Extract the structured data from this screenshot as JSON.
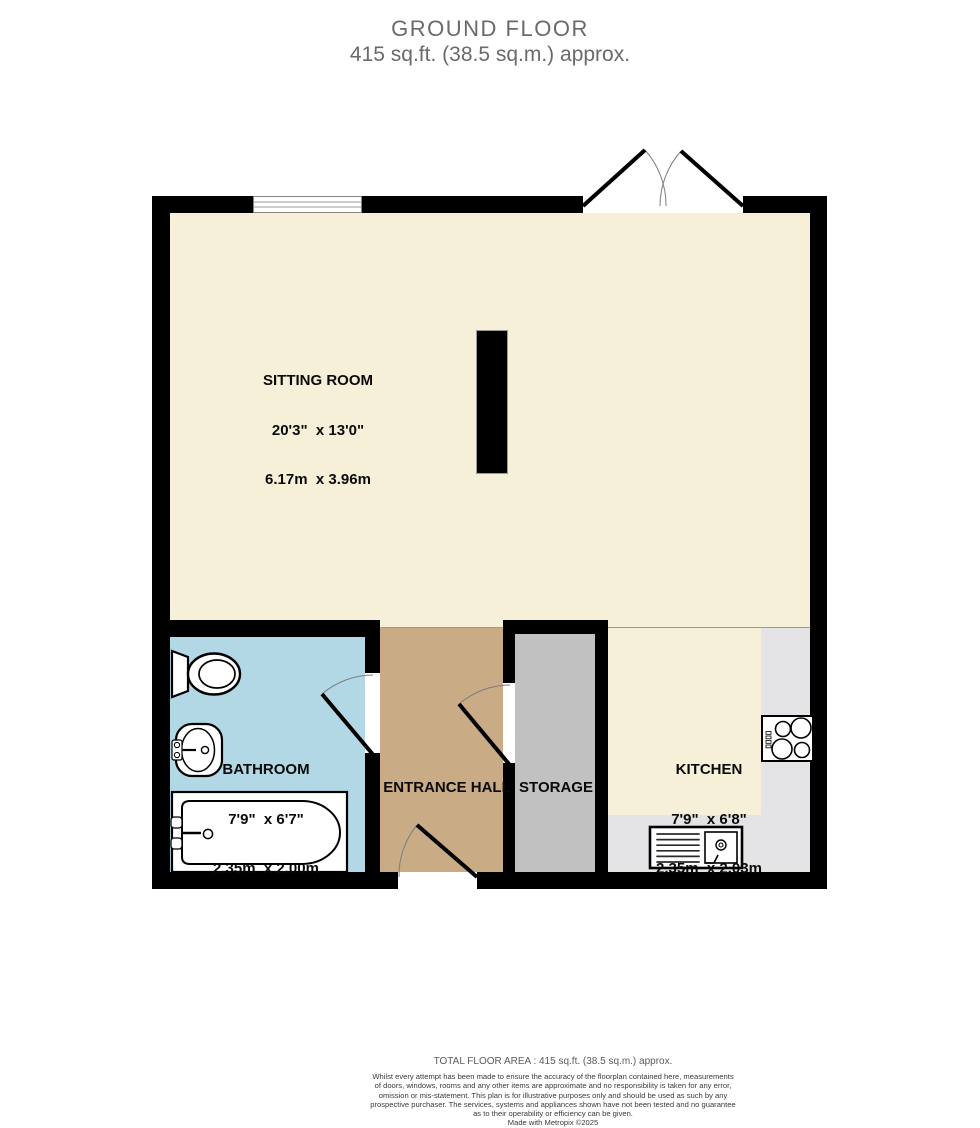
{
  "title": {
    "line1": "GROUND FLOOR",
    "line2": "415 sq.ft. (38.5 sq.m.) approx."
  },
  "plan": {
    "rooms": {
      "sitting_room": {
        "name": "SITTING ROOM",
        "imperial": "20'3\"  x 13'0\"",
        "metric": "6.17m  x 3.96m",
        "floor_color": "#F6F0D8"
      },
      "bathroom": {
        "name": "BATHROOM",
        "imperial": "7'9\"  x 6'7\"",
        "metric": "2.35m  x 2.00m",
        "floor_color": "#B3D8E5"
      },
      "entrance_hall": {
        "name": "ENTRANCE HALL",
        "floor_color": "#C9AC85"
      },
      "storage": {
        "name": "STORAGE",
        "floor_color": "#C1C1C1"
      },
      "kitchen": {
        "name": "KITCHEN",
        "imperial": "7'9\"  x 6'8\"",
        "metric": "2.35m  x 2.03m",
        "floor_color": "#F6F0D8",
        "counter_color": "#E4E4E7"
      }
    },
    "fixtures": [
      "toilet-icon",
      "wash-basin-icon",
      "bathtub-icon",
      "hob-icon",
      "kitchen-sink-icon",
      "window-icon",
      "french-doors-icon",
      "bathroom-door-icon",
      "storage-door-icon",
      "entrance-door-icon",
      "chimney-breast"
    ],
    "colors": {
      "wall": "#000000",
      "title_text": "#6A6A6A",
      "door_arc": "#7d7d7d"
    }
  },
  "footer": {
    "total_area": "TOTAL FLOOR AREA : 415 sq.ft. (38.5 sq.m.) approx.",
    "disclaimer_lines": [
      "Whilst every attempt has been made to ensure the accuracy of the floorplan contained here, measurements",
      "of doors, windows, rooms and any other items are approximate and no responsibility is taken for any error,",
      "omission or mis-statement. This plan is for illustrative purposes only and should be used as such by any",
      "prospective purchaser. The services, systems and appliances shown have not been tested and no guarantee",
      "as to their operability or efficiency can be given."
    ],
    "credit": "Made with Metropix ©2025"
  }
}
